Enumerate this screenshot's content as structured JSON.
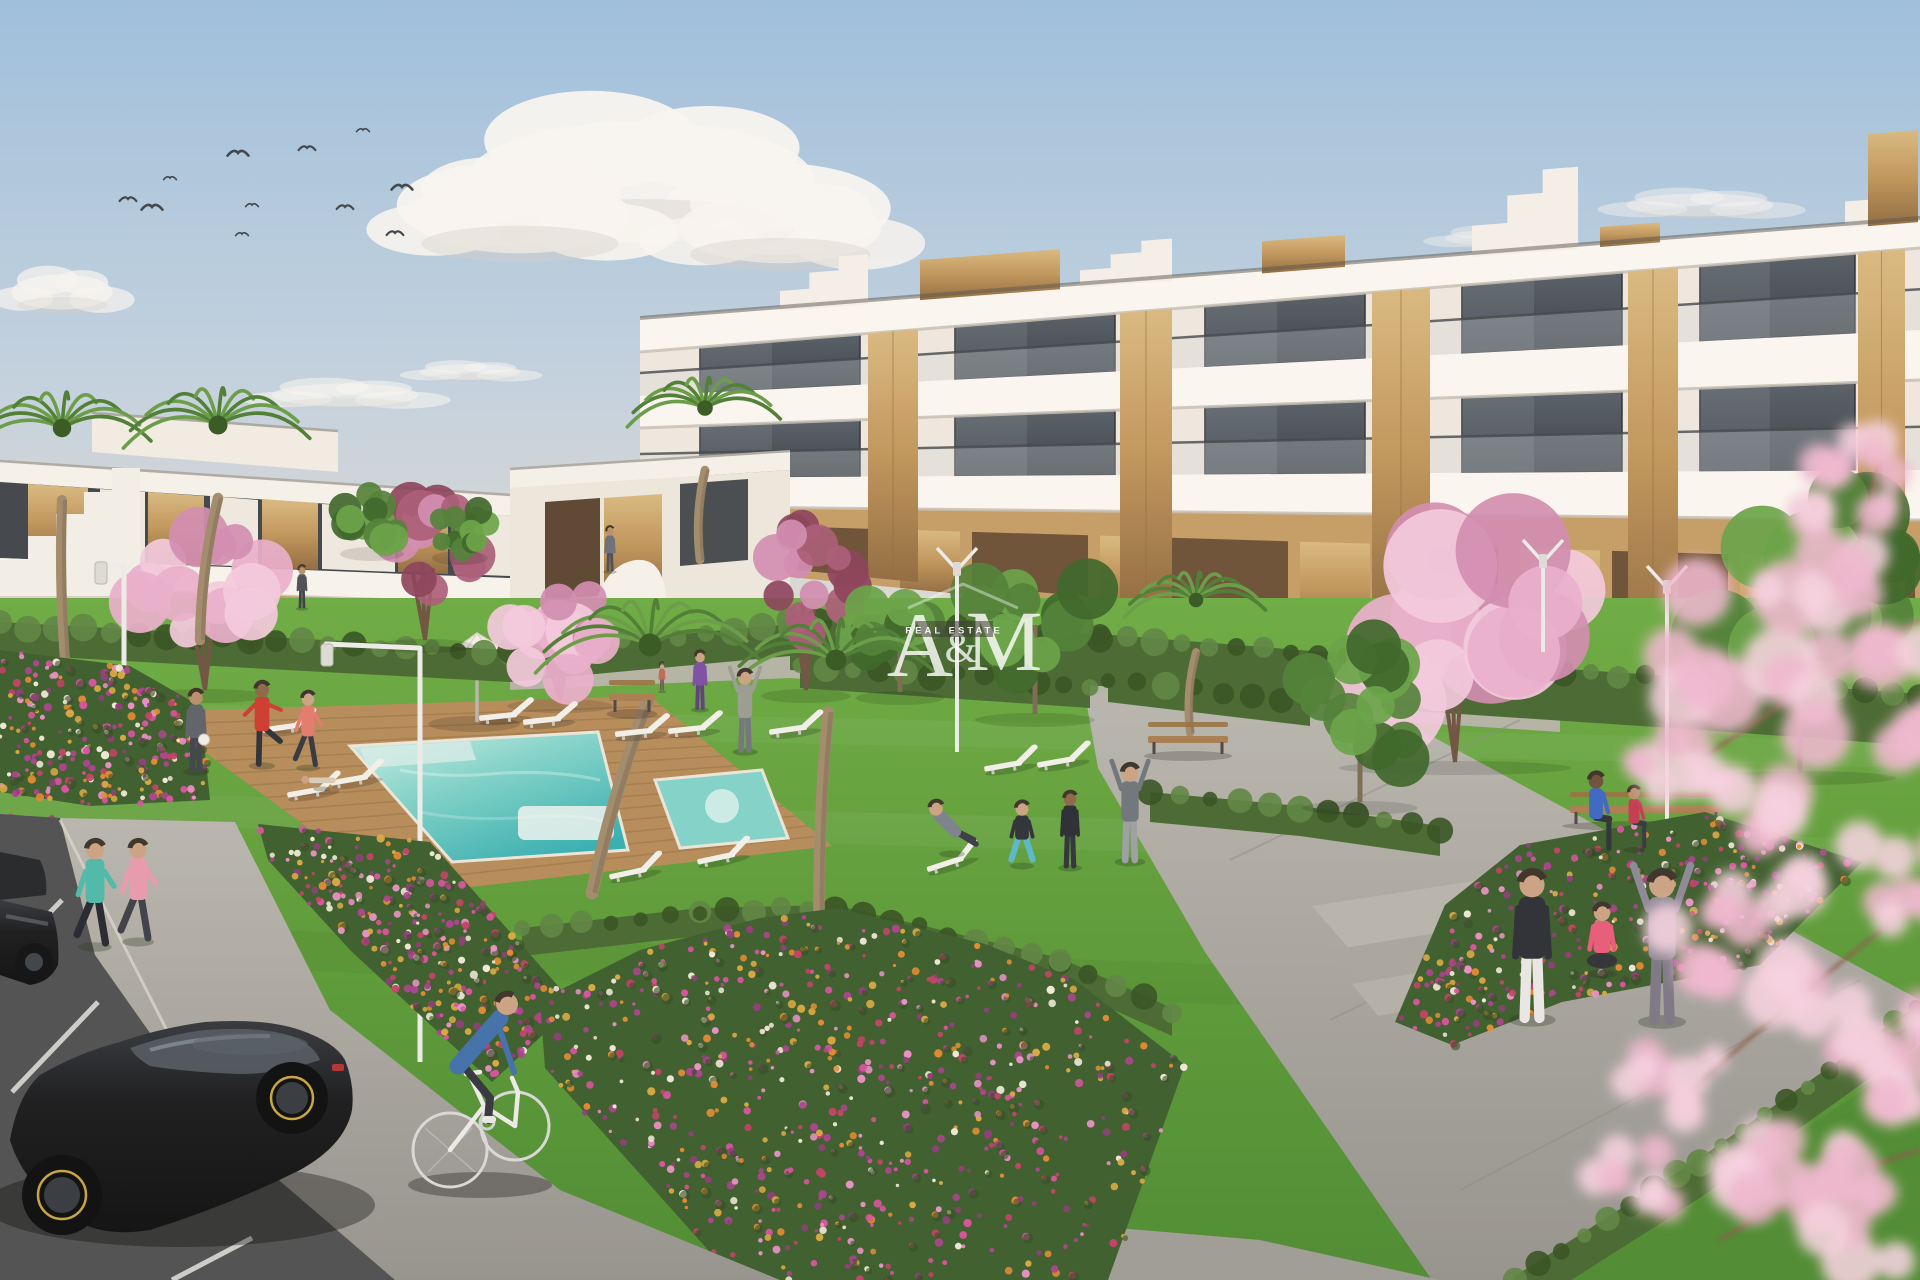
{
  "watermark": {
    "letter_a": "A",
    "ampersand": "&",
    "letter_m": "M",
    "tagline": "REAL ESTATE",
    "color": "#ffffff",
    "tagline_bg": "#3a3632"
  },
  "palette": {
    "sky_top": "#9dbedd",
    "sky_mid": "#c3d2de",
    "sky_horizon": "#e4dcd0",
    "cloud": "#f8f5f1",
    "cloud_shade": "#d6cdc6",
    "building_white": "#f5f0e9",
    "building_shade": "#e6dfd4",
    "slab_shadow": "#c6bfb5",
    "glass_dark": "#394046",
    "glass_light": "#565e66",
    "glass_reflect": "#8b97a0",
    "wood": "#bf9459",
    "wood_dark": "#8f6a3e",
    "wood_light": "#d9b97f",
    "tan_wall": "#c49c64",
    "tan_dark": "#5f462f",
    "hedge": "#46682f",
    "hedge_light": "#5c8440",
    "hedge_dark": "#33511f",
    "lawn_light": "#6cab41",
    "lawn_dark": "#4c8a2f",
    "deck": "#b68a58",
    "deck_line": "#8d6940",
    "pool_shallow": "#cdeee6",
    "pool_deep": "#35aeb0",
    "path": "#b4b1aa",
    "asphalt": "#4e4f51",
    "stall_line": "#e2e1dd",
    "cherry_pink": "#e9aecb",
    "cherry_pale": "#f3c9dd",
    "cherry_deep": "#d18bb0",
    "burgundy": "#8a4059",
    "burgundy_light": "#a85a75",
    "palm_green": "#4c7c33",
    "palm_light": "#679c45",
    "palm_dark": "#33571f",
    "trunk": "#a08a6a",
    "tree_green": "#4e7f35",
    "tree_green_light": "#66a244",
    "car_black": "#17181a",
    "rim_yellow": "#c7a43c",
    "bird": "#3d4248",
    "lamp": "#ececea"
  },
  "birds": [
    [
      363,
      130
    ],
    [
      307,
      148
    ],
    [
      238,
      153
    ],
    [
      170,
      178
    ],
    [
      128,
      199
    ],
    [
      152,
      207
    ],
    [
      252,
      205
    ],
    [
      345,
      207
    ],
    [
      402,
      187
    ],
    [
      242,
      234
    ],
    [
      395,
      233
    ]
  ],
  "clouds": [
    {
      "x": 640,
      "y": 182,
      "s": 1.9,
      "o": 0.95,
      "flat": 0
    },
    {
      "x": 520,
      "y": 215,
      "s": 1.2,
      "o": 0.9,
      "flat": 0
    },
    {
      "x": 780,
      "y": 228,
      "s": 1.1,
      "o": 0.85,
      "flat": 0
    },
    {
      "x": 62,
      "y": 292,
      "s": 0.55,
      "o": 0.7,
      "flat": 0
    },
    {
      "x": 345,
      "y": 395,
      "s": 0.8,
      "o": 0.55,
      "flat": 1
    },
    {
      "x": 470,
      "y": 372,
      "s": 0.55,
      "o": 0.5,
      "flat": 1
    },
    {
      "x": 1030,
      "y": 356,
      "s": 0.6,
      "o": 0.45,
      "flat": 1
    },
    {
      "x": 1275,
      "y": 372,
      "s": 0.5,
      "o": 0.4,
      "flat": 1
    },
    {
      "x": 1700,
      "y": 205,
      "s": 0.8,
      "o": 0.45,
      "flat": 1
    },
    {
      "x": 1500,
      "y": 238,
      "s": 0.6,
      "o": 0.4,
      "flat": 1
    },
    {
      "x": 1150,
      "y": 330,
      "s": 0.5,
      "o": 0.35,
      "flat": 1
    }
  ],
  "building_right": {
    "x0": 640,
    "x1": 1920,
    "facade": {
      "top": [
        318,
        218
      ],
      "bot": [
        562,
        690
      ]
    },
    "ground": {
      "top": [
        506,
        520
      ],
      "open_top": [
        522,
        560
      ],
      "open_bot": [
        556,
        672
      ],
      "bot": [
        562,
        690
      ],
      "wood": [
        [
          700,
          760
        ],
        [
          900,
          960
        ],
        [
          1100,
          1160
        ],
        [
          1300,
          1370
        ],
        [
          1520,
          1600
        ],
        [
          1740,
          1820
        ]
      ],
      "openings": [
        [
          772,
          888
        ],
        [
          972,
          1088
        ],
        [
          1172,
          1288
        ],
        [
          1382,
          1498
        ],
        [
          1612,
          1728
        ],
        [
          1832,
          1915
        ]
      ]
    },
    "rows": [
      {
        "top": [
          348,
          245
        ],
        "bot": [
          396,
          330
        ],
        "windows": [
          [
            700,
            860
          ],
          [
            955,
            1115
          ],
          [
            1205,
            1365
          ],
          [
            1462,
            1622
          ],
          [
            1700,
            1855
          ]
        ]
      },
      {
        "top": [
          428,
          380
        ],
        "bot": [
          478,
          470
        ],
        "windows": [
          [
            700,
            860
          ],
          [
            955,
            1115
          ],
          [
            1205,
            1365
          ],
          [
            1462,
            1622
          ],
          [
            1700,
            1855
          ]
        ]
      }
    ],
    "slabs": [
      {
        "top": [
          318,
          218
        ],
        "bot": [
          352,
          248
        ]
      },
      {
        "top": [
          396,
          330
        ],
        "bot": [
          428,
          380
        ]
      },
      {
        "top": [
          478,
          470
        ],
        "bot": [
          506,
          520
        ]
      }
    ],
    "wood_cols": [
      [
        868,
        918
      ],
      [
        1120,
        1172
      ],
      [
        1372,
        1430
      ],
      [
        1628,
        1678
      ],
      [
        1858,
        1905
      ]
    ],
    "roof": [
      {
        "t": "step",
        "x": [
          780,
          868
        ],
        "h": 46
      },
      {
        "t": "wood",
        "x": [
          920,
          1060
        ],
        "h": 36
      },
      {
        "t": "step",
        "x": [
          1080,
          1172
        ],
        "h": 38
      },
      {
        "t": "wood",
        "x": [
          1262,
          1345
        ],
        "h": 28
      },
      {
        "t": "step",
        "x": [
          1472,
          1578
        ],
        "h": 78
      },
      {
        "t": "wood",
        "x": [
          1600,
          1660
        ],
        "h": 16
      },
      {
        "t": "step",
        "x": [
          1845,
          1918
        ],
        "h": 64
      },
      {
        "t": "wood",
        "x": [
          1868,
          1918
        ],
        "h": 88
      }
    ]
  },
  "hedges": [
    {
      "pts": [
        [
          0,
          622
        ],
        [
          250,
          636
        ],
        [
          510,
          650
        ],
        [
          790,
          624
        ]
      ],
      "w": 32
    },
    {
      "pts": [
        [
          790,
          618
        ],
        [
          1100,
          634
        ],
        [
          1400,
          658
        ],
        [
          1700,
          678
        ],
        [
          1920,
          694
        ]
      ],
      "w": 52
    },
    {
      "pts": [
        [
          800,
          662
        ],
        [
          1090,
          682
        ]
      ],
      "w": 26
    },
    {
      "pts": [
        [
          1108,
          676
        ],
        [
          1310,
          700
        ]
      ],
      "w": 26
    },
    {
      "pts": [
        [
          1150,
          792
        ],
        [
          1300,
          806
        ],
        [
          1440,
          826
        ]
      ],
      "w": 30
    },
    {
      "pts": [
        [
          1515,
          1276
        ],
        [
          1700,
          1158
        ],
        [
          1916,
          1006
        ]
      ],
      "w": 40
    },
    {
      "pts": [
        [
          522,
          928
        ],
        [
          700,
          908
        ],
        [
          835,
          905
        ],
        [
          1060,
          958
        ],
        [
          1172,
          1008
        ]
      ],
      "w": 28
    }
  ],
  "flower_colors": [
    "#d8509f",
    "#e890c4",
    "#e2892e",
    "#d9a83f",
    "#aa3f8d",
    "#f0ead8",
    "#c23e64",
    "#8e3a78"
  ],
  "flower_beds": [
    {
      "name": "bed-far-left",
      "pts": [
        [
          0,
          650
        ],
        [
          130,
          666
        ],
        [
          200,
          706
        ],
        [
          210,
          800
        ],
        [
          90,
          806
        ],
        [
          0,
          792
        ]
      ],
      "n": 260
    },
    {
      "name": "bed-left-diagonal",
      "pts": [
        [
          258,
          824
        ],
        [
          430,
          842
        ],
        [
          575,
          1005
        ],
        [
          492,
          1082
        ],
        [
          350,
          950
        ],
        [
          268,
          860
        ]
      ],
      "n": 300
    },
    {
      "name": "bed-top-left",
      "pts": [
        [
          0,
          816
        ],
        [
          58,
          818
        ],
        [
          46,
          860
        ],
        [
          0,
          858
        ]
      ],
      "n": 50
    },
    {
      "name": "bed-center",
      "pts": [
        [
          540,
          1000
        ],
        [
          640,
          950
        ],
        [
          760,
          918
        ],
        [
          838,
          908
        ],
        [
          985,
          944
        ],
        [
          1075,
          980
        ],
        [
          1185,
          1065
        ],
        [
          1108,
          1280
        ],
        [
          735,
          1280
        ],
        [
          545,
          1068
        ]
      ],
      "n": 650
    },
    {
      "name": "bed-right",
      "pts": [
        [
          1395,
          1022
        ],
        [
          1445,
          905
        ],
        [
          1520,
          845
        ],
        [
          1705,
          812
        ],
        [
          1862,
          862
        ],
        [
          1760,
          965
        ],
        [
          1562,
          1002
        ],
        [
          1452,
          1045
        ]
      ],
      "n": 340
    }
  ],
  "palms": [
    {
      "x": 62,
      "y": 428,
      "r": 92,
      "trunk": [
        62,
        500,
        70,
        714
      ]
    },
    {
      "x": 218,
      "y": 425,
      "r": 95,
      "trunk": [
        218,
        498,
        200,
        640
      ]
    },
    {
      "x": 705,
      "y": 408,
      "r": 78,
      "trunk": [
        705,
        470,
        700,
        560
      ]
    },
    {
      "x": 1196,
      "y": 600,
      "r": 72,
      "trunk": [
        1196,
        652,
        1190,
        733
      ]
    },
    {
      "x": 650,
      "y": 645,
      "r": 115,
      "trunk": [
        648,
        700,
        592,
        893
      ]
    },
    {
      "x": 836,
      "y": 660,
      "r": 105,
      "trunk": [
        828,
        712,
        820,
        968
      ]
    }
  ],
  "cherries": [
    {
      "x": 205,
      "y": 592,
      "rx": 78,
      "ry": 70,
      "ty": 690,
      "kind": "pink"
    },
    {
      "x": 425,
      "y": 545,
      "rx": 62,
      "ry": 58,
      "ty": 640,
      "kind": "burg"
    },
    {
      "x": 560,
      "y": 632,
      "rx": 66,
      "ry": 60,
      "ty": 700,
      "kind": "pink"
    },
    {
      "x": 806,
      "y": 580,
      "rx": 56,
      "ry": 68,
      "ty": 690,
      "kind": "burg"
    },
    {
      "x": 1455,
      "y": 628,
      "rx": 145,
      "ry": 105,
      "ty": 762,
      "kind": "pink"
    }
  ],
  "green_trees": [
    {
      "x": 372,
      "y": 520,
      "rx": 40,
      "ry": 30,
      "ty": 548
    },
    {
      "x": 460,
      "y": 528,
      "rx": 35,
      "ry": 26,
      "ty": 552
    },
    {
      "x": 900,
      "y": 628,
      "rx": 55,
      "ry": 55,
      "ty": 692
    },
    {
      "x": 1035,
      "y": 625,
      "rx": 75,
      "ry": 78,
      "ty": 714
    },
    {
      "x": 1360,
      "y": 712,
      "rx": 72,
      "ry": 80,
      "ty": 802
    },
    {
      "x": 1800,
      "y": 590,
      "rx": 120,
      "ry": 150,
      "ty": 772
    },
    {
      "x": 782,
      "y": 995,
      "rx": 62,
      "ry": 88,
      "ty": 1175
    }
  ],
  "lamps": [
    {
      "kind": "arm",
      "poleX": 124,
      "poleTop": 566,
      "poleBot": 702,
      "armX": 100,
      "armY": 562
    },
    {
      "kind": "arm",
      "poleX": 420,
      "poleTop": 648,
      "poleBot": 1062,
      "armX": 326,
      "armY": 644
    },
    {
      "kind": "v",
      "x": 957,
      "top": 548,
      "bot": 752
    },
    {
      "kind": "v",
      "x": 1543,
      "top": 540,
      "bot": 652
    },
    {
      "kind": "v",
      "x": 1667,
      "top": 566,
      "bot": 962
    }
  ],
  "benches": [
    {
      "x": 632,
      "y": 700,
      "w": 46
    },
    {
      "x": 1188,
      "y": 742,
      "w": 80
    },
    {
      "x": 1646,
      "y": 812,
      "w": 152
    }
  ],
  "loungers": [
    [
      505,
      716,
      -6
    ],
    [
      549,
      720,
      -6
    ],
    [
      641,
      732,
      -6
    ],
    [
      694,
      729,
      -6
    ],
    [
      288,
      727,
      -8
    ],
    [
      313,
      791,
      -10
    ],
    [
      356,
      779,
      -10
    ],
    [
      635,
      872,
      -12
    ],
    [
      723,
      857,
      -12
    ],
    [
      795,
      729,
      -8
    ],
    [
      1010,
      765,
      -10
    ],
    [
      1063,
      761,
      -10
    ],
    [
      952,
      862,
      -18
    ]
  ],
  "people": [
    {
      "name": "jogger-teal",
      "x": 95,
      "y": 945,
      "h": 105,
      "pose": "run",
      "shirt": "#4db8a8",
      "pants": "#23252e",
      "skin": "#caa183"
    },
    {
      "name": "jogger-pink",
      "x": 138,
      "y": 940,
      "h": 100,
      "pose": "run",
      "shirt": "#e799ad",
      "pants": "#3c3d47",
      "skin": "#caa183"
    },
    {
      "name": "man-with-ball",
      "x": 196,
      "y": 770,
      "h": 80,
      "pose": "stand",
      "shirt": "#5c6167",
      "pants": "#3e4249",
      "skin": "#b98e6a"
    },
    {
      "name": "man-kicking",
      "x": 262,
      "y": 764,
      "h": 82,
      "pose": "kick",
      "shirt": "#cc3a2e",
      "pants": "#2c2e36",
      "skin": "#8a6648"
    },
    {
      "name": "woman-coral",
      "x": 308,
      "y": 766,
      "h": 74,
      "pose": "run",
      "shirt": "#e2796a",
      "pants": "#34353d",
      "skin": "#caa183"
    },
    {
      "name": "person-lounging",
      "x": 322,
      "y": 787,
      "h": 56,
      "pose": "lying",
      "shirt": "#d9c9b8",
      "pants": "#b8a898",
      "skin": "#caa183"
    },
    {
      "name": "man-stretching-up",
      "x": 745,
      "y": 750,
      "h": 80,
      "pose": "arms-up",
      "shirt": "#999c90",
      "pants": "#70747a",
      "skin": "#caa183"
    },
    {
      "name": "man-deckchair",
      "x": 952,
      "y": 852,
      "h": 80,
      "pose": "recline",
      "shirt": "#7b828b",
      "pants": "#383b42",
      "skin": "#caa183"
    },
    {
      "name": "woman-squatting",
      "x": 1022,
      "y": 864,
      "h": 76,
      "pose": "squat",
      "shirt": "#2c2f36",
      "pants": "#57b7c9",
      "skin": "#caa183"
    },
    {
      "name": "child-tracksuit",
      "x": 1070,
      "y": 866,
      "h": 74,
      "pose": "stand",
      "shirt": "#292b31",
      "pants": "#2f3138",
      "skin": "#8a6648"
    },
    {
      "name": "man-side-stretch",
      "x": 1130,
      "y": 860,
      "h": 96,
      "pose": "arms-up",
      "shirt": "#6e747a",
      "pants": "#9b9ea2",
      "skin": "#caa183"
    },
    {
      "name": "woman-purple",
      "x": 700,
      "y": 708,
      "h": 56,
      "pose": "stand",
      "shirt": "#7a4da2",
      "pants": "#5a3f7a",
      "skin": "#caa183"
    },
    {
      "name": "child-path",
      "x": 662,
      "y": 690,
      "h": 26,
      "pose": "stand",
      "shirt": "#c06a52",
      "pants": "#6a5a4a",
      "skin": "#caa183"
    },
    {
      "name": "figure-distant-left",
      "x": 302,
      "y": 607,
      "h": 40,
      "pose": "stand",
      "shirt": "#4a4e55",
      "pants": "#3a3d43",
      "skin": "#b98e6a"
    },
    {
      "name": "figure-distant-mid",
      "x": 610,
      "y": 570,
      "h": 42,
      "pose": "stand",
      "shirt": "#6a6e75",
      "pants": "#4a4d53",
      "skin": "#b98e6a"
    },
    {
      "name": "man-bench",
      "x": 1596,
      "y": 850,
      "h": 86,
      "pose": "sit",
      "shirt": "#3a67c2",
      "pants": "#2e3037",
      "skin": "#6e4f38"
    },
    {
      "name": "child-bench",
      "x": 1634,
      "y": 848,
      "h": 68,
      "pose": "sit",
      "shirt": "#c23a50",
      "pants": "#343640",
      "skin": "#b98e6a"
    },
    {
      "name": "woman-standing-right",
      "x": 1532,
      "y": 1018,
      "h": 148,
      "pose": "stand",
      "shirt": "#2b2d33",
      "pants": "#e9e7e4",
      "skin": "#caa183"
    },
    {
      "name": "woman-sitting-pink",
      "x": 1602,
      "y": 972,
      "h": 95,
      "pose": "sit-ground",
      "shirt": "#e85a78",
      "pants": "#2e3036",
      "skin": "#caa183"
    },
    {
      "name": "person-arms-raised",
      "x": 1662,
      "y": 1020,
      "h": 150,
      "pose": "arms-up",
      "shirt": "#8c8694",
      "pants": "#7b7684",
      "skin": "#caa183"
    }
  ],
  "blossom_overlay": [
    [
      1742,
      640,
      95
    ],
    [
      1820,
      560,
      70
    ],
    [
      1880,
      700,
      85
    ],
    [
      1695,
      760,
      60
    ],
    [
      1790,
      830,
      75
    ],
    [
      1730,
      940,
      65
    ],
    [
      1850,
      1000,
      80
    ],
    [
      1668,
      1080,
      55
    ],
    [
      1780,
      1150,
      70
    ],
    [
      1880,
      1210,
      75
    ],
    [
      1640,
      1180,
      45
    ],
    [
      1905,
      880,
      60
    ],
    [
      1870,
      480,
      55
    ],
    [
      1910,
      1080,
      70
    ]
  ]
}
